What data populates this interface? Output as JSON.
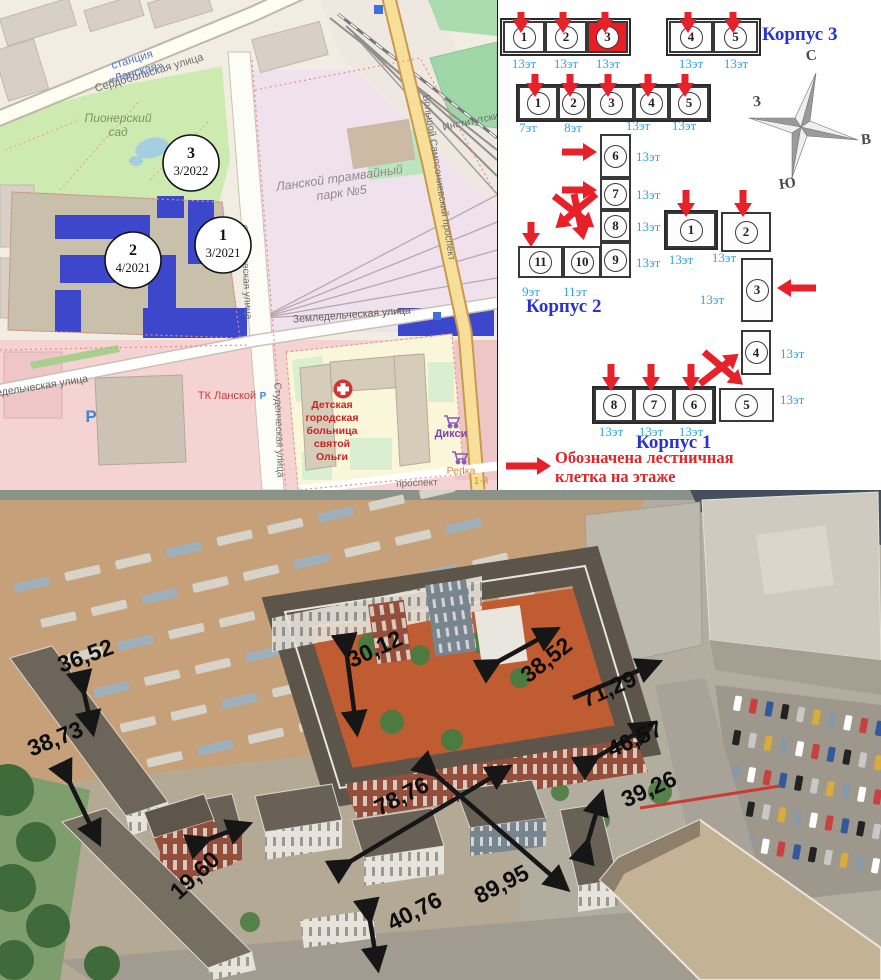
{
  "map": {
    "markers": [
      {
        "num": "1",
        "date": "3/2021"
      },
      {
        "num": "2",
        "date": "4/2021"
      },
      {
        "num": "3",
        "date": "3/2022"
      }
    ],
    "labels": {
      "station": "станция «Ланская»",
      "park": "Пионерский сад",
      "tram_park": "Ланской трамвайный парк №5",
      "street_serdobolskaya": "Сердобольская улица",
      "street_studencheskaya": "Студенческая улица",
      "street_zemledelcheskaya": "Земледельческая улица",
      "street_sampsonievsky": "Большой Сампсониевский проспект",
      "street_institutsky": "Институтский",
      "hospital": "Детская городская больница святой Ольги",
      "mall": "ТК Ланской",
      "shop_diksi": "Дикси",
      "shop_repka": "Репка",
      "street_prospekt": "проспект",
      "street_1y": "1-й",
      "parking_big": "P",
      "parking_small": "P"
    }
  },
  "scheme": {
    "korpus3": {
      "label": "Корпус 3",
      "sections": [
        {
          "num": "1",
          "floors": "13эт"
        },
        {
          "num": "2",
          "floors": "13эт"
        },
        {
          "num": "3",
          "floors": "13эт",
          "highlighted": true
        },
        {
          "num": "4",
          "floors": "13эт"
        },
        {
          "num": "5",
          "floors": "13эт"
        }
      ]
    },
    "korpus2": {
      "label": "Корпус 2",
      "sections": [
        {
          "num": "1",
          "floors": "7эт"
        },
        {
          "num": "2",
          "floors": "8эт"
        },
        {
          "num": "3",
          "floors": ""
        },
        {
          "num": "4",
          "floors": "13эт"
        },
        {
          "num": "5",
          "floors": "13эт"
        },
        {
          "num": "6",
          "floors": "13эт"
        },
        {
          "num": "7",
          "floors": "13эт"
        },
        {
          "num": "8",
          "floors": "13эт"
        },
        {
          "num": "9",
          "floors": "13эт"
        },
        {
          "num": "10",
          "floors": "11эт"
        },
        {
          "num": "11",
          "floors": "9эт"
        }
      ]
    },
    "korpus1": {
      "label": "Корпус 1",
      "sections": [
        {
          "num": "1",
          "floors": "13эт"
        },
        {
          "num": "2",
          "floors": "13эт"
        },
        {
          "num": "3",
          "floors": "13эт"
        },
        {
          "num": "4",
          "floors": "13эт"
        },
        {
          "num": "5",
          "floors": "13эт"
        },
        {
          "num": "6",
          "floors": "13эт"
        },
        {
          "num": "7",
          "floors": "13эт"
        },
        {
          "num": "8",
          "floors": "13эт"
        }
      ]
    },
    "compass": {
      "north": "С",
      "east": "В",
      "south": "Ю",
      "west": "З"
    },
    "legend": {
      "text": "Обозначена лестничная клетка на этаже"
    }
  },
  "photo": {
    "dimensions": [
      "36,52",
      "30,12",
      "38,52",
      "71,29",
      "46,57",
      "39,26",
      "38,73",
      "78,76",
      "19,60",
      "40,76",
      "89,95"
    ]
  }
}
